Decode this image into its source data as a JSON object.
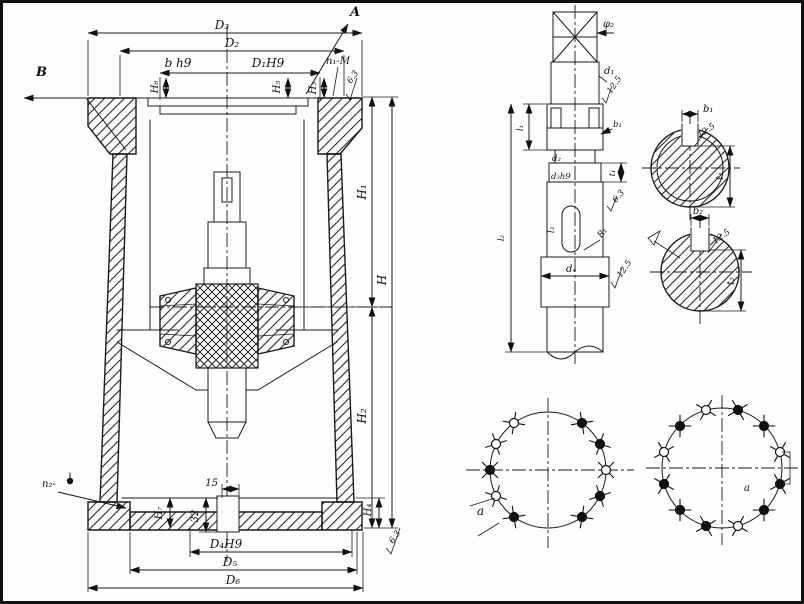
{
  "housing_view": {
    "callout_a": "A",
    "callout_b": "B",
    "dim_d3": "D₃",
    "dim_d2": "D₂",
    "dim_b_h9": "b h9",
    "dim_d1h9": "D₁H9",
    "dim_h6": "H₆",
    "dim_h5": "H₅",
    "label_n1": "n₁-M",
    "dim_h3": "H₃",
    "rough_top": "6.3",
    "dim_h1": "H₁",
    "dim_h": "H",
    "dim_h2": "H₂",
    "dim_h4": "H₄",
    "dim_h7": "H₇",
    "rough_bottom": "6.3",
    "label_n2": "n₂-",
    "dim_15": "15",
    "dim_32": "32",
    "dim_d4h9": "D₄H9",
    "dim_d5": "D₅",
    "dim_d6": "D₆"
  },
  "shaft_view": {
    "dim_phi2": "φ₂",
    "dim_d1": "d₁",
    "rough_d1": "12.5",
    "dim_d2": "d₂",
    "dim_d3h9": "d₃h9",
    "dim_b1": "b₁",
    "dim_t1": "t₁",
    "dim_l1": "l₁",
    "dim_l2": "l₂",
    "dim_l3": "l₃",
    "dim_r1": "R₁",
    "rough_key": "6.3",
    "dim_d4": "d₄",
    "rough_d4": "12.5"
  },
  "section_b1": {
    "dim_b1": "b₁",
    "rough": "12.5",
    "dim_t1": "t₁"
  },
  "section_b2": {
    "dim_b2": "b₂",
    "rough": "12.5",
    "dim_t2": "t₂"
  },
  "bolt_circle_left": {
    "angle_label": "a",
    "hole_count": 10
  },
  "bolt_circle_right": {
    "angle_label": "a",
    "hole_count": 12
  },
  "colors": {
    "ink": "#1a1a1a",
    "paper": "#fdfdfb"
  }
}
